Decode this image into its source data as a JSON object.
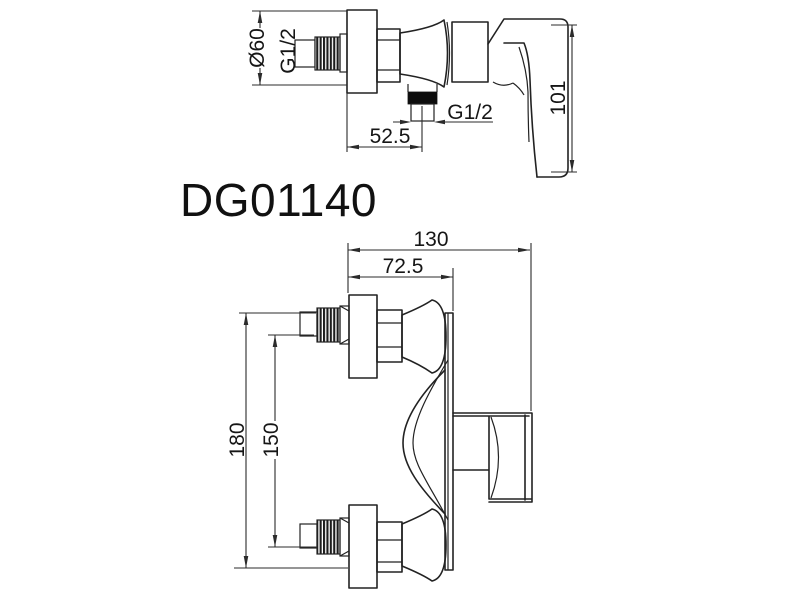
{
  "product": {
    "model": "DG01140"
  },
  "colors": {
    "line": "#222222",
    "dimension_line": "#2b2b2b",
    "outlet_band": "#0d0d0d",
    "thread_dark": "#1c1c1c",
    "background": "#ffffff"
  },
  "side_view": {
    "dims": {
      "flange_diameter": "Ø60",
      "inlet_thread": "G1/2",
      "wall_to_outlet": "52.5",
      "outlet_thread": "G1/2",
      "handle_height": "101"
    }
  },
  "front_view": {
    "dims": {
      "overall_width": "130",
      "wall_to_body_face": "72.5",
      "overall_height": "180",
      "inlet_center_distance": "150"
    }
  }
}
